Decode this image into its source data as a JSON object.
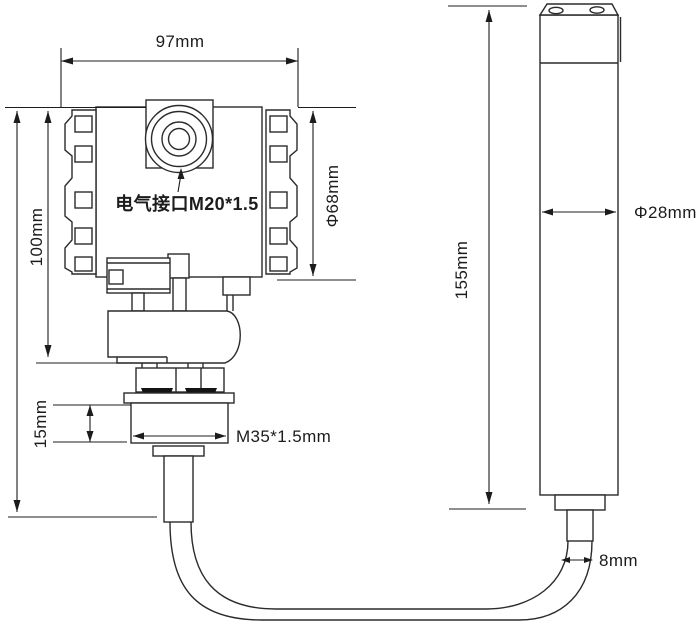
{
  "diagram": {
    "type": "technical-dimension-drawing",
    "labels": {
      "housing_width": "97mm",
      "housing_height": "100mm",
      "housing_diameter": "Φ68mm",
      "electrical_port": "电气接口M20*1.5",
      "thread_height": "15mm",
      "thread_spec": "M35*1.5mm",
      "probe_height": "155mm",
      "probe_diameter": "Φ28mm",
      "cable_diameter": "8mm"
    },
    "colors": {
      "line": "#2b2b2b",
      "dimension": "#1c1c1c",
      "text": "#1c1c1c",
      "seal_fill": "#141414",
      "background": "#ffffff"
    }
  }
}
